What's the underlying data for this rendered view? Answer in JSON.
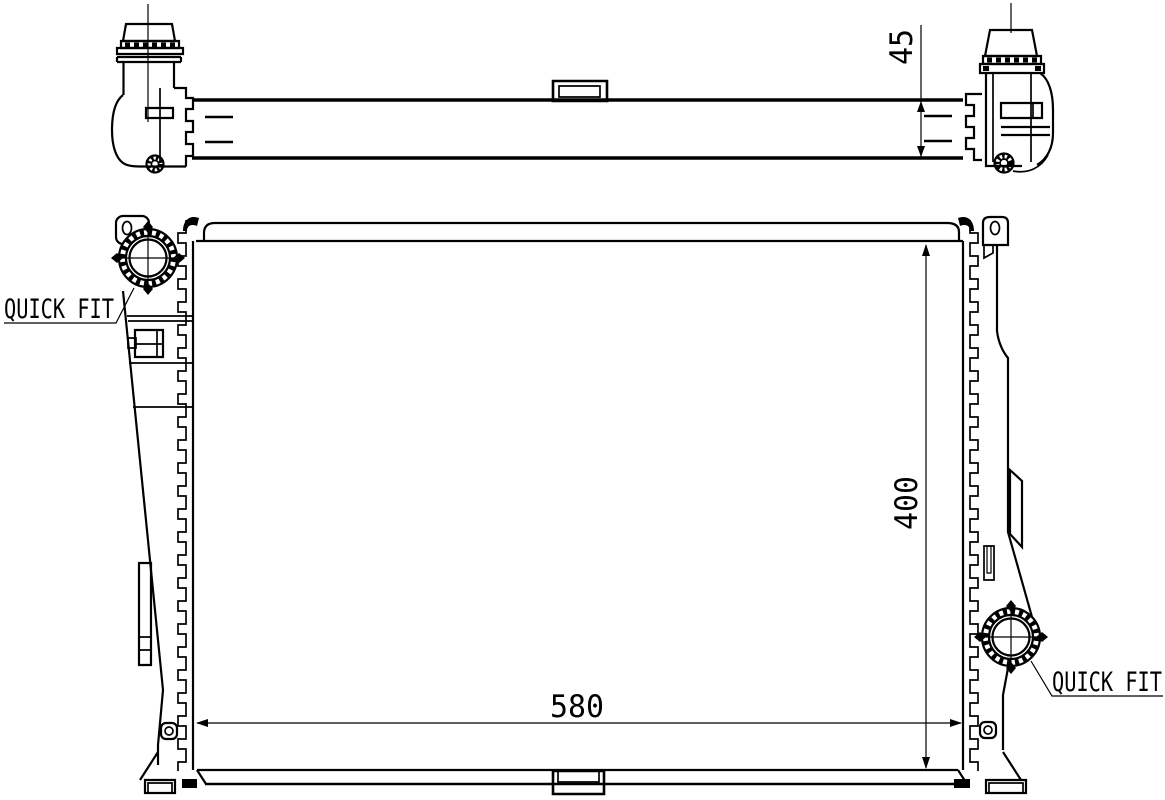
{
  "labels": {
    "quick_fit_top": "QUICK FIT",
    "quick_fit_bottom": "QUICK FIT"
  },
  "dimensions": {
    "depth": "45",
    "width": "580",
    "height": "400"
  },
  "colors": {
    "line": "#000000",
    "background": "#ffffff"
  }
}
